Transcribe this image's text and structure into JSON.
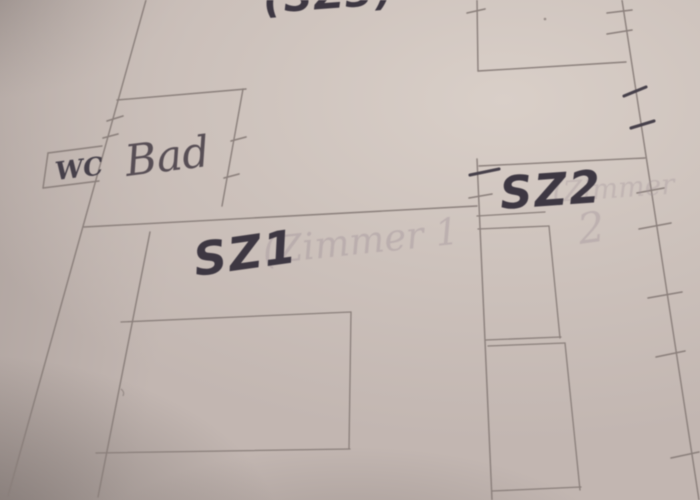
{
  "meta": {
    "description": "Photograph of a hand-drawn apartment floor plan sketched in pencil on paper, room labels written over erased text",
    "language": "German"
  },
  "colors": {
    "paper": "#c2b6b1",
    "paper_highlight": "#d9cfc8",
    "paper_shadow": "#7d7370",
    "pencil": "#8a7f7b",
    "pencil_soft": "#978c88",
    "pencil_dark": "#6e6465",
    "pen": "#3d3742",
    "pen_bold": "#46404a",
    "ghost": "#a3959b"
  },
  "floor_plan": {
    "rooms": {
      "sz3": {
        "label": "(SZ3)",
        "note": "label cut off at top edge of photo"
      },
      "wc": {
        "label": "WC"
      },
      "bad": {
        "label": "Bad"
      },
      "sz1": {
        "label": "SZ1",
        "ghost": "(Zimmer 1"
      },
      "sz2": {
        "label": "SZ2",
        "ghost": "(Zimmer",
        "ghost_number": "2"
      }
    }
  }
}
